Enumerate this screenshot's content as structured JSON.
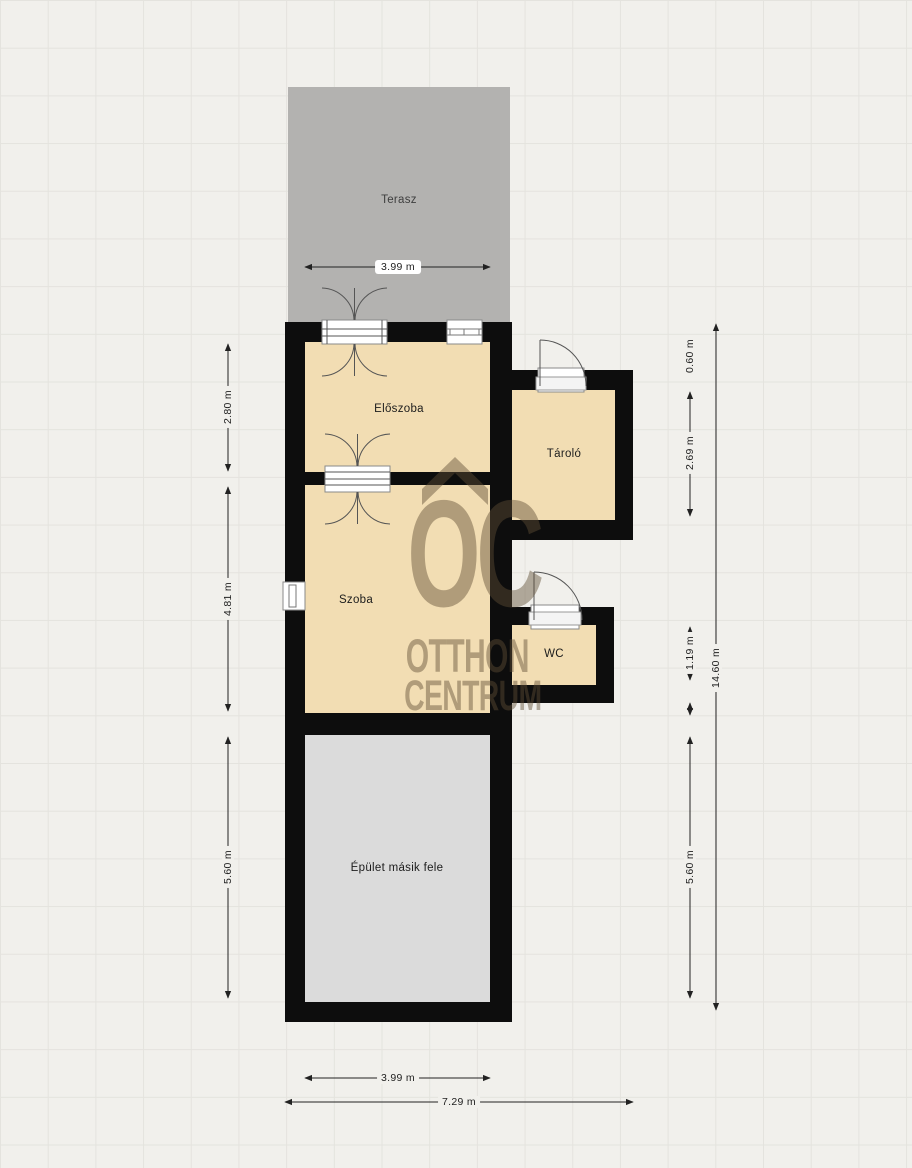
{
  "watermark": {
    "logo_text": "OC",
    "line1": "OTTHON",
    "line2": "CENTRUM"
  },
  "rooms": {
    "terasz": {
      "label": "Terasz"
    },
    "eloszoba": {
      "label": "Előszoba"
    },
    "tarolo": {
      "label": "Tároló"
    },
    "szoba": {
      "label": "Szoba"
    },
    "wc": {
      "label": "WC"
    },
    "epulet": {
      "label": "Épület másik fele"
    }
  },
  "dimensions": {
    "terrace_width": "3.99 m",
    "eloszoba_height": "2.80 m",
    "szoba_height": "4.81 m",
    "lower_left_height": "5.60 m",
    "tarolo_top_offset": "0.60 m",
    "tarolo_height": "2.69 m",
    "wc_height": "1.19 m",
    "lower_right_height": "5.60 m",
    "total_height": "14.60 m",
    "bottom_width": "3.99 m",
    "total_width": "7.29 m"
  },
  "colors": {
    "wall": "#0d0d0d",
    "room_fill": "#f2ddb3",
    "terrace_fill": "#b3b2b0",
    "secondary_fill": "#dbdbdb",
    "background": "#f1f0ec",
    "grid_line": "#e4e3de",
    "dimension": "#222222",
    "watermark": "rgba(95,78,54,0.45)"
  }
}
